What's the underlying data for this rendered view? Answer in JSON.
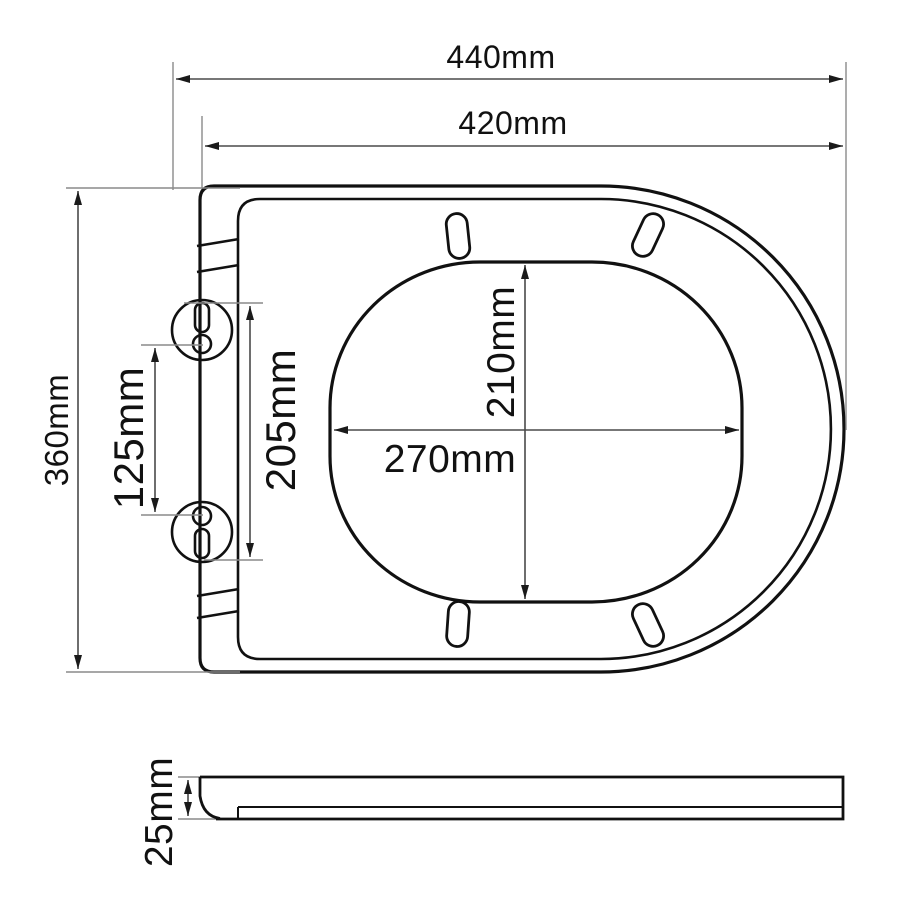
{
  "canvas": {
    "width": 900,
    "height": 900,
    "background": "#ffffff"
  },
  "colors": {
    "outline": "#111111",
    "dimension_line": "#4a4a4a",
    "extension_line": "#8a8a8a",
    "arrowhead": "#1a1a1a",
    "label_text": "#111111"
  },
  "units": "mm",
  "dimensions": {
    "overall_width": {
      "label": "440mm",
      "mm": 440
    },
    "seat_body_width": {
      "label": "420mm",
      "mm": 420
    },
    "overall_depth": {
      "label": "360mm",
      "mm": 360
    },
    "hinge_hole_spacing": {
      "label": "125mm",
      "mm": 125
    },
    "hinge_span": {
      "label": "205mm",
      "mm": 205
    },
    "opening_depth": {
      "label": "210mm",
      "mm": 210
    },
    "opening_width": {
      "label": "270mm",
      "mm": 270
    },
    "seat_thickness": {
      "label": "25mm",
      "mm": 25
    }
  }
}
